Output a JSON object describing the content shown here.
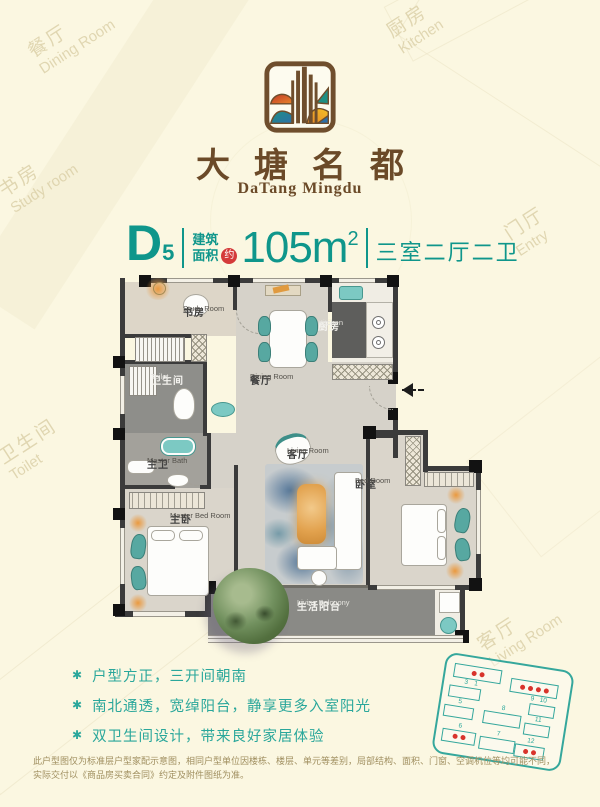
{
  "colors": {
    "background": "#FBF7E1",
    "accent_teal": "#0F968B",
    "feature_teal": "#2AA79B",
    "brand_brown": "#6B4A28",
    "badge_red": "#D43A3A",
    "wall_dark": "#3B3B3B",
    "floor_light": "#D6D2C9",
    "floor_dark": "#8A8A86",
    "fixture_teal": "#7CC9C3",
    "accent_orange": "#E2A24E",
    "site_dot_red": "#D8332B"
  },
  "brand": {
    "name_cn": "大塘名都",
    "name_en": "DaTang Mingdu"
  },
  "spec": {
    "unit_letter": "D",
    "unit_number": "5",
    "area_label_top": "建筑",
    "area_label_bottom": "面积",
    "approx": "约",
    "area_value": "105m",
    "area_exponent": "2",
    "layout_text": "三室二厅二卫"
  },
  "floorplan": {
    "rooms": {
      "study": {
        "cn": "书房",
        "en": "Study Room"
      },
      "dining": {
        "cn": "餐厅",
        "en": "Dining Room"
      },
      "kitchen": {
        "cn": "厨房",
        "en": "Kitchen"
      },
      "toilet": {
        "cn": "卫生间",
        "en": "Toilet"
      },
      "master_bath": {
        "cn": "主卫",
        "en": "Master Bath"
      },
      "master_bed": {
        "cn": "主卧",
        "en": "Master Bed Room"
      },
      "living": {
        "cn": "客厅",
        "en": "Living Room"
      },
      "bedroom": {
        "cn": "卧室",
        "en": "Bed Room"
      },
      "balcony": {
        "cn": "生活阳台",
        "en": "Living Balcoony"
      }
    }
  },
  "features": [
    "户型方正，三开间朝南",
    "南北通透，宽绰阳台，静享更多入室阳光",
    "双卫生间设计，带来良好家居体验"
  ],
  "disclaimer": {
    "line1": "此户型图仅为标准层户型家配示意图，相同户型单位因楼栋、楼层、单元等差别，局部结构、面积、门窗、空调机位等均可能不同，",
    "line2": "实际交付以《商品房买卖合同》约定及附件图纸为准。"
  },
  "siteplan": {
    "buildings": [
      {
        "num": "1",
        "dots": 2
      },
      {
        "num": "3",
        "dots": 0
      },
      {
        "num": "5",
        "dots": 0
      },
      {
        "num": "6",
        "dots": 2
      },
      {
        "num": "7",
        "dots": 0
      },
      {
        "num": "8",
        "dots": 0
      },
      {
        "num": "9",
        "dots": 4
      },
      {
        "num": "10",
        "dots": 0
      },
      {
        "num": "11",
        "dots": 0
      },
      {
        "num": "12",
        "dots": 2
      }
    ]
  },
  "watermarks": [
    {
      "cn": "餐厅",
      "en": "Dining Room"
    },
    {
      "cn": "厨房",
      "en": "Kitchen"
    },
    {
      "cn": "书房",
      "en": "Study room"
    },
    {
      "cn": "门厅",
      "en": "Entry"
    },
    {
      "cn": "卫生间",
      "en": "Toilet"
    },
    {
      "cn": "客厅",
      "en": "Living Room"
    }
  ]
}
